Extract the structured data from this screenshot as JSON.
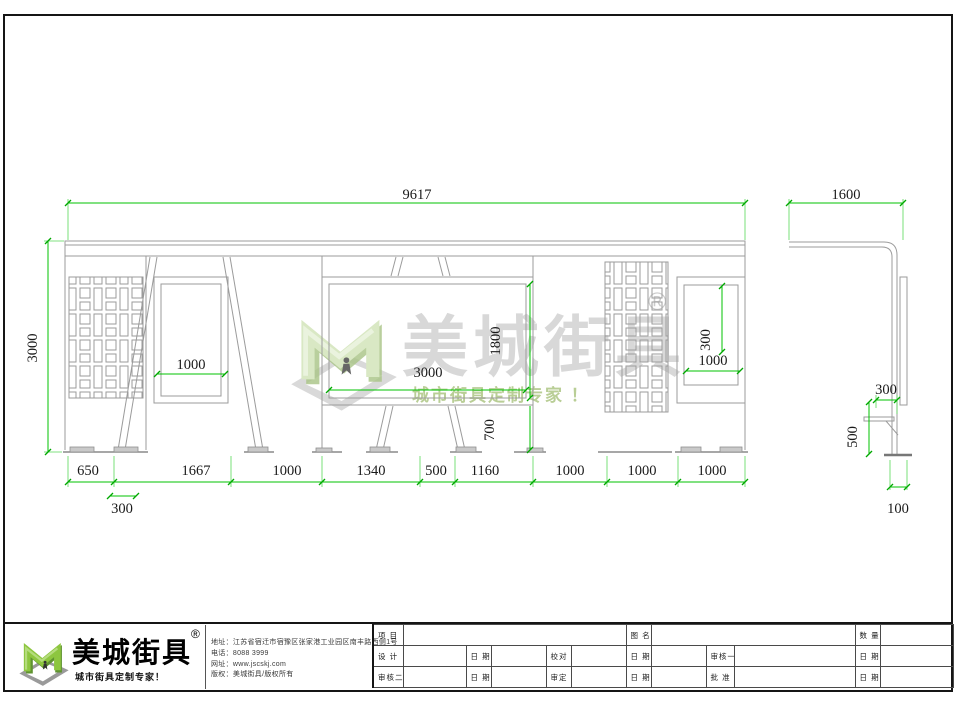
{
  "colors": {
    "dimension_green": "#00c300",
    "drawing_gray": "#9b9b9b",
    "logo_green": "#8dc63f",
    "watermark_text_gray": "#d8d8d8",
    "watermark_text_green": "#b9ce96"
  },
  "watermark": {
    "brand": "美城街具",
    "registered": "®",
    "tagline": "城市街具定制专家 ！"
  },
  "front_view": {
    "dim_total_width": "9617",
    "dim_height": "3000",
    "dim_panel1_width": "1000",
    "dim_screen_width": "3000",
    "dim_screen_height": "1800",
    "dim_under_screen": "700",
    "dim_panel2_height": "300",
    "dim_panel2_width": "1000",
    "dims_bottom": [
      "650",
      "1667",
      "1000",
      "1340",
      "500",
      "1160",
      "1000",
      "1000",
      "1000"
    ],
    "dim_offset_left": "300"
  },
  "side_view": {
    "dim_depth": "1600",
    "dim_seat_depth": "300",
    "dim_seat_height": "500",
    "dim_base": "100"
  },
  "footer": {
    "brand": "美城街具",
    "registered": "®",
    "tagline": "城市街具定制专家！",
    "contact_lines": [
      "地址：江苏省宿迁市宿豫区张家港工业园区南丰路西侧1号",
      "电话：8088 3999",
      "网址：www.jscskj.com",
      "版权：美城街具/版权所有"
    ],
    "title_block": {
      "row1": [
        "项 目",
        "",
        "图 名",
        "",
        "数 量",
        ""
      ],
      "row2": [
        "设 计",
        "",
        "日 期",
        "",
        "校对",
        "",
        "日 期",
        "",
        "审核一",
        "",
        "日 期",
        ""
      ],
      "row3": [
        "审核二",
        "",
        "日 期",
        "",
        "审定",
        "",
        "日 期",
        "",
        "批 准",
        "",
        "日 期",
        ""
      ]
    }
  }
}
